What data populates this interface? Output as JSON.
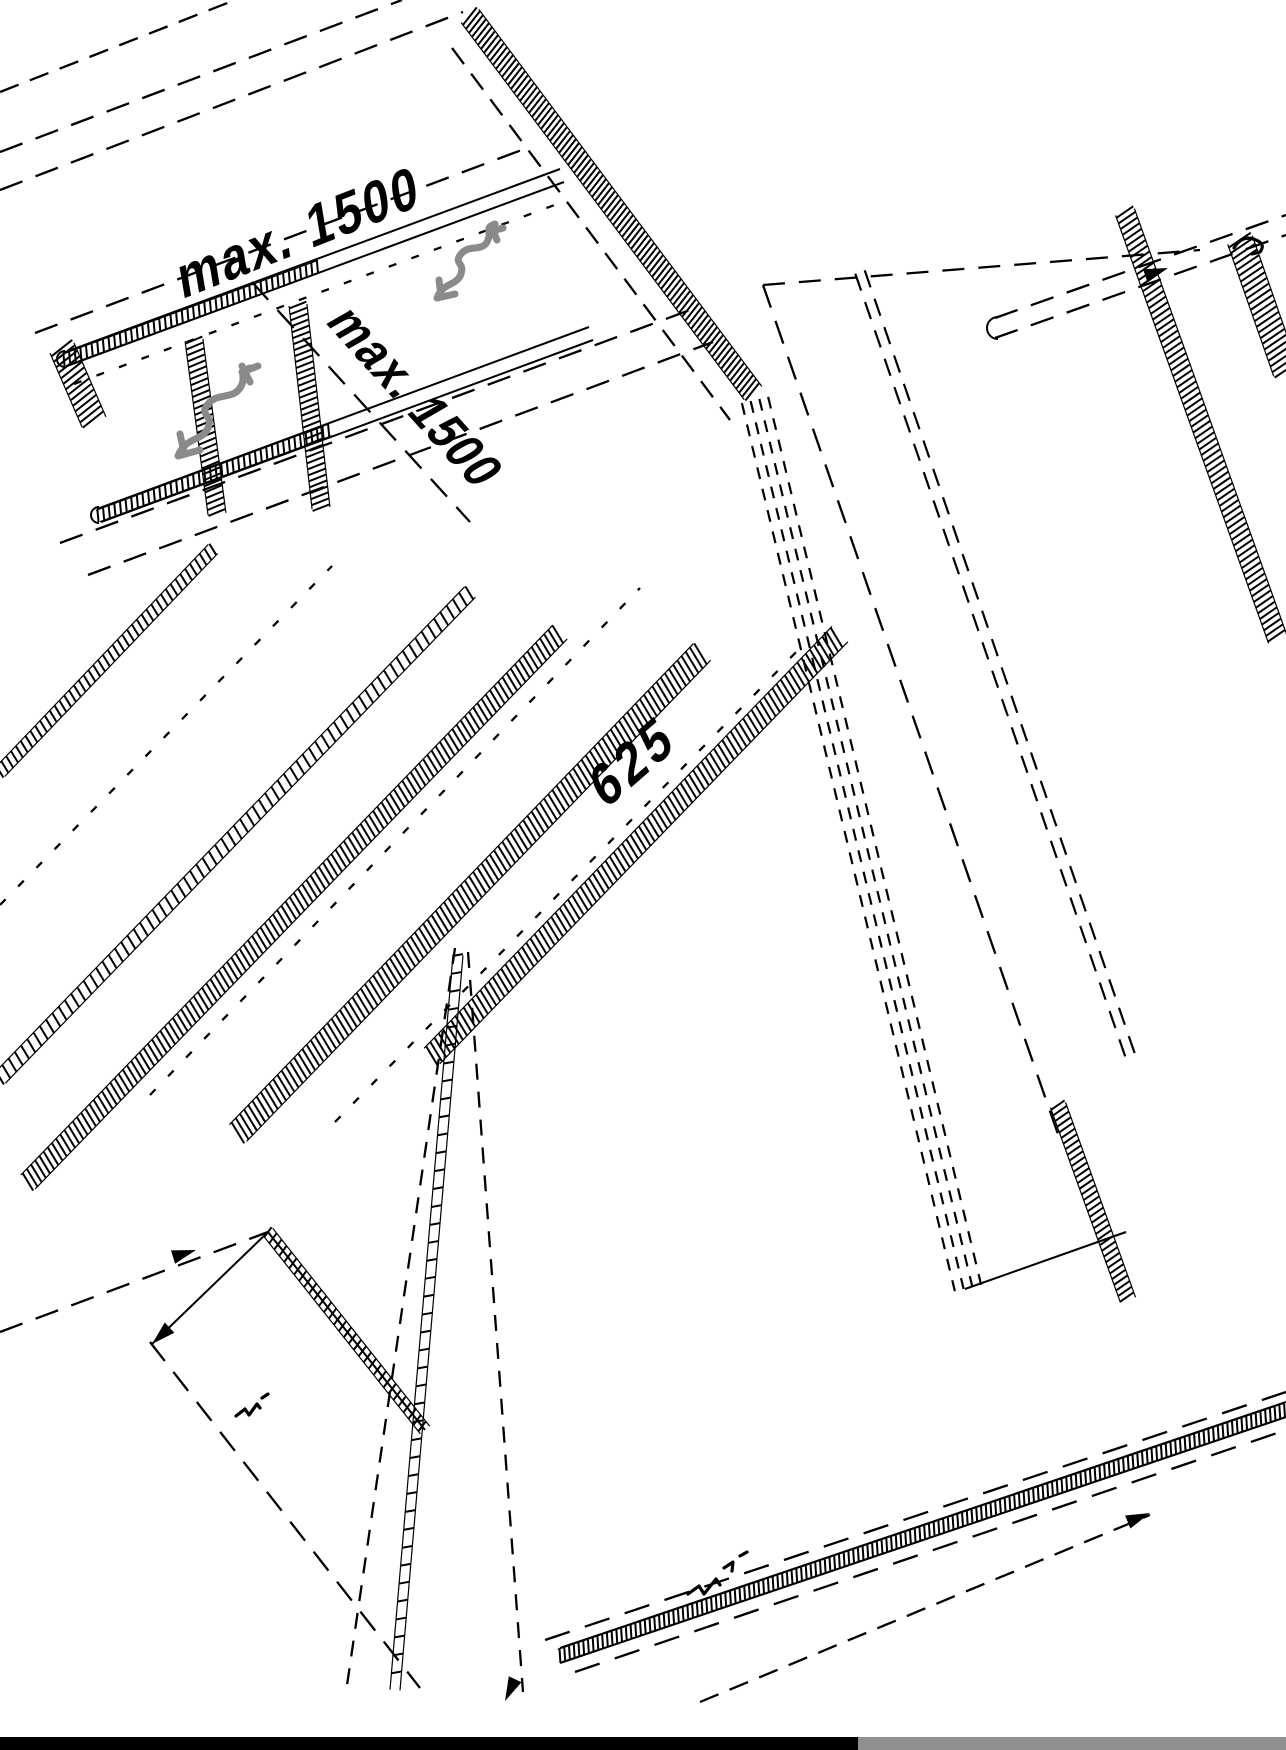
{
  "figure_type": "isometric technical assembly drawing (black line art on white)",
  "drawing": {
    "ink_color": "#000000",
    "annotation_gray": "#8a8a8a",
    "base_bar_black": "#000000",
    "base_bar_gray": "#8f8f8f",
    "labels": [
      {
        "id": "dim-max-1500-top",
        "text": "max. 1500"
      },
      {
        "id": "dim-max-1500-side",
        "text": "max. 1500"
      },
      {
        "id": "dim-625-center",
        "text": "625"
      }
    ],
    "hatch_bands": [
      [
        470,
        16,
        753,
        393,
        22,
        5
      ],
      [
        62,
        348,
        94,
        422,
        26,
        6
      ],
      [
        194,
        340,
        217,
        514,
        18,
        6
      ],
      [
        298,
        305,
        321,
        508,
        18,
        6
      ],
      [
        64,
        360,
        320,
        266,
        12,
        6
      ],
      [
        98,
        516,
        330,
        430,
        12,
        6
      ],
      [
        0,
        772,
        213,
        549,
        13,
        7
      ],
      [
        0,
        1078,
        470,
        592,
        15,
        9
      ],
      [
        28,
        1182,
        560,
        632,
        20,
        6
      ],
      [
        238,
        1133,
        702,
        652,
        24,
        6
      ],
      [
        432,
        1056,
        840,
        634,
        22,
        6
      ],
      [
        1125,
        212,
        1278,
        640,
        20,
        6
      ],
      [
        1240,
        240,
        1286,
        372,
        26,
        6
      ],
      [
        1058,
        1105,
        1128,
        1300,
        16,
        6
      ],
      [
        268,
        1232,
        425,
        1430,
        12,
        8
      ],
      [
        458,
        955,
        395,
        1690,
        10,
        18
      ],
      [
        560,
        1656,
        1286,
        1410,
        14,
        5
      ]
    ],
    "dashed_lines": [
      [
        0,
        152,
        402,
        0,
        "24 14"
      ],
      [
        0,
        92,
        235,
        0,
        "20 12"
      ],
      [
        0,
        190,
        463,
        12,
        "24 14"
      ],
      [
        35,
        333,
        527,
        148,
        "24 14"
      ],
      [
        252,
        282,
        470,
        522,
        "24 14"
      ],
      [
        60,
        543,
        690,
        310,
        "24 14"
      ],
      [
        88,
        575,
        713,
        342,
        "24 14"
      ],
      [
        452,
        48,
        730,
        420,
        "20 12"
      ],
      [
        763,
        285,
        1060,
        1140,
        "24 14"
      ],
      [
        763,
        285,
        1200,
        250,
        "22 14"
      ],
      [
        995,
        318,
        1286,
        215,
        "24 14"
      ],
      [
        995,
        338,
        1286,
        235,
        "24 14"
      ],
      [
        0,
        1332,
        268,
        1232,
        "24 14"
      ],
      [
        150,
        1342,
        420,
        1688,
        "24 14"
      ],
      [
        455,
        948,
        346,
        1692,
        "16 12"
      ],
      [
        468,
        952,
        523,
        1692,
        "16 12"
      ],
      [
        545,
        1640,
        1286,
        1392,
        "26 16"
      ],
      [
        575,
        1672,
        1286,
        1430,
        "26 16"
      ],
      [
        700,
        1702,
        1150,
        1515,
        "20 12"
      ],
      [
        150,
        1095,
        640,
        588,
        "8 18"
      ],
      [
        335,
        1122,
        808,
        640,
        "8 18"
      ],
      [
        0,
        905,
        332,
        566,
        "8 18"
      ],
      [
        74,
        384,
        568,
        200,
        "8 16"
      ]
    ],
    "multi_dashed": [
      [
        755,
        400,
        968,
        1288,
        4,
        9,
        "12 10"
      ],
      [
        860,
        272,
        1130,
        1055,
        2,
        10,
        "18 12"
      ]
    ],
    "solid_lines": [
      [
        63,
        353,
        560,
        169
      ],
      [
        67,
        366,
        564,
        182
      ],
      [
        97,
        509,
        589,
        327
      ],
      [
        101,
        522,
        593,
        340
      ],
      [
        560,
        1648,
        1286,
        1402
      ],
      [
        560,
        1663,
        1286,
        1417
      ],
      [
        268,
        1232,
        425,
        1430
      ],
      [
        268,
        1232,
        152,
        1344
      ],
      [
        965,
        1289,
        1126,
        1232
      ]
    ],
    "end_caps": [
      [
        65,
        359,
        8
      ],
      [
        99,
        515,
        8
      ],
      [
        998,
        328,
        11
      ]
    ],
    "arrows": [
      [
        196,
        1250,
        -17
      ],
      [
        1168,
        268,
        -19
      ],
      [
        1150,
        1513,
        -22
      ],
      [
        505,
        1701,
        115
      ],
      [
        152,
        1344,
        137
      ]
    ],
    "gray_squiggles": [
      "M437 298 c6 -16 20 -12 24 -24 c4 -12 -8 -10 0 -20 c8 -10 20 -2 26 -12 c6 -10 -4 -14 8 -18 M437 298 l18 -4 M441 296 l-2 -16 M489 232 l14 -4 M497 240 l-6 -14",
      "M178 456 c8 -20 24 -14 30 -28 c6 -14 -10 -12 0 -24 c10 -12 24 -4 32 -16 c8 -12 -4 -16 10 -20 M178 456 l22 -6 M184 452 l-4 -18 M242 372 l16 -6 M250 382 l-8 -16"
    ],
    "black_marks": [
      "M236 1416 l9 -7 l4 6 l8 -11 l3 4 M262 1398 l6 -4",
      "M688 1594 l11 -8 l5 8 l12 -15 l4 6 M724 1568 l9 -6 l-1 9 M740 1556 l7 -4",
      "M1234 248 q8 -14 22 -8 q10 4 4 12 l-8 2"
    ],
    "base_bars": [
      {
        "x": 0,
        "y": 1737,
        "w": 858,
        "h": 13,
        "color_key": "base_bar_black"
      },
      {
        "x": 858,
        "y": 1737,
        "w": 428,
        "h": 13,
        "color_key": "base_bar_gray"
      }
    ]
  }
}
